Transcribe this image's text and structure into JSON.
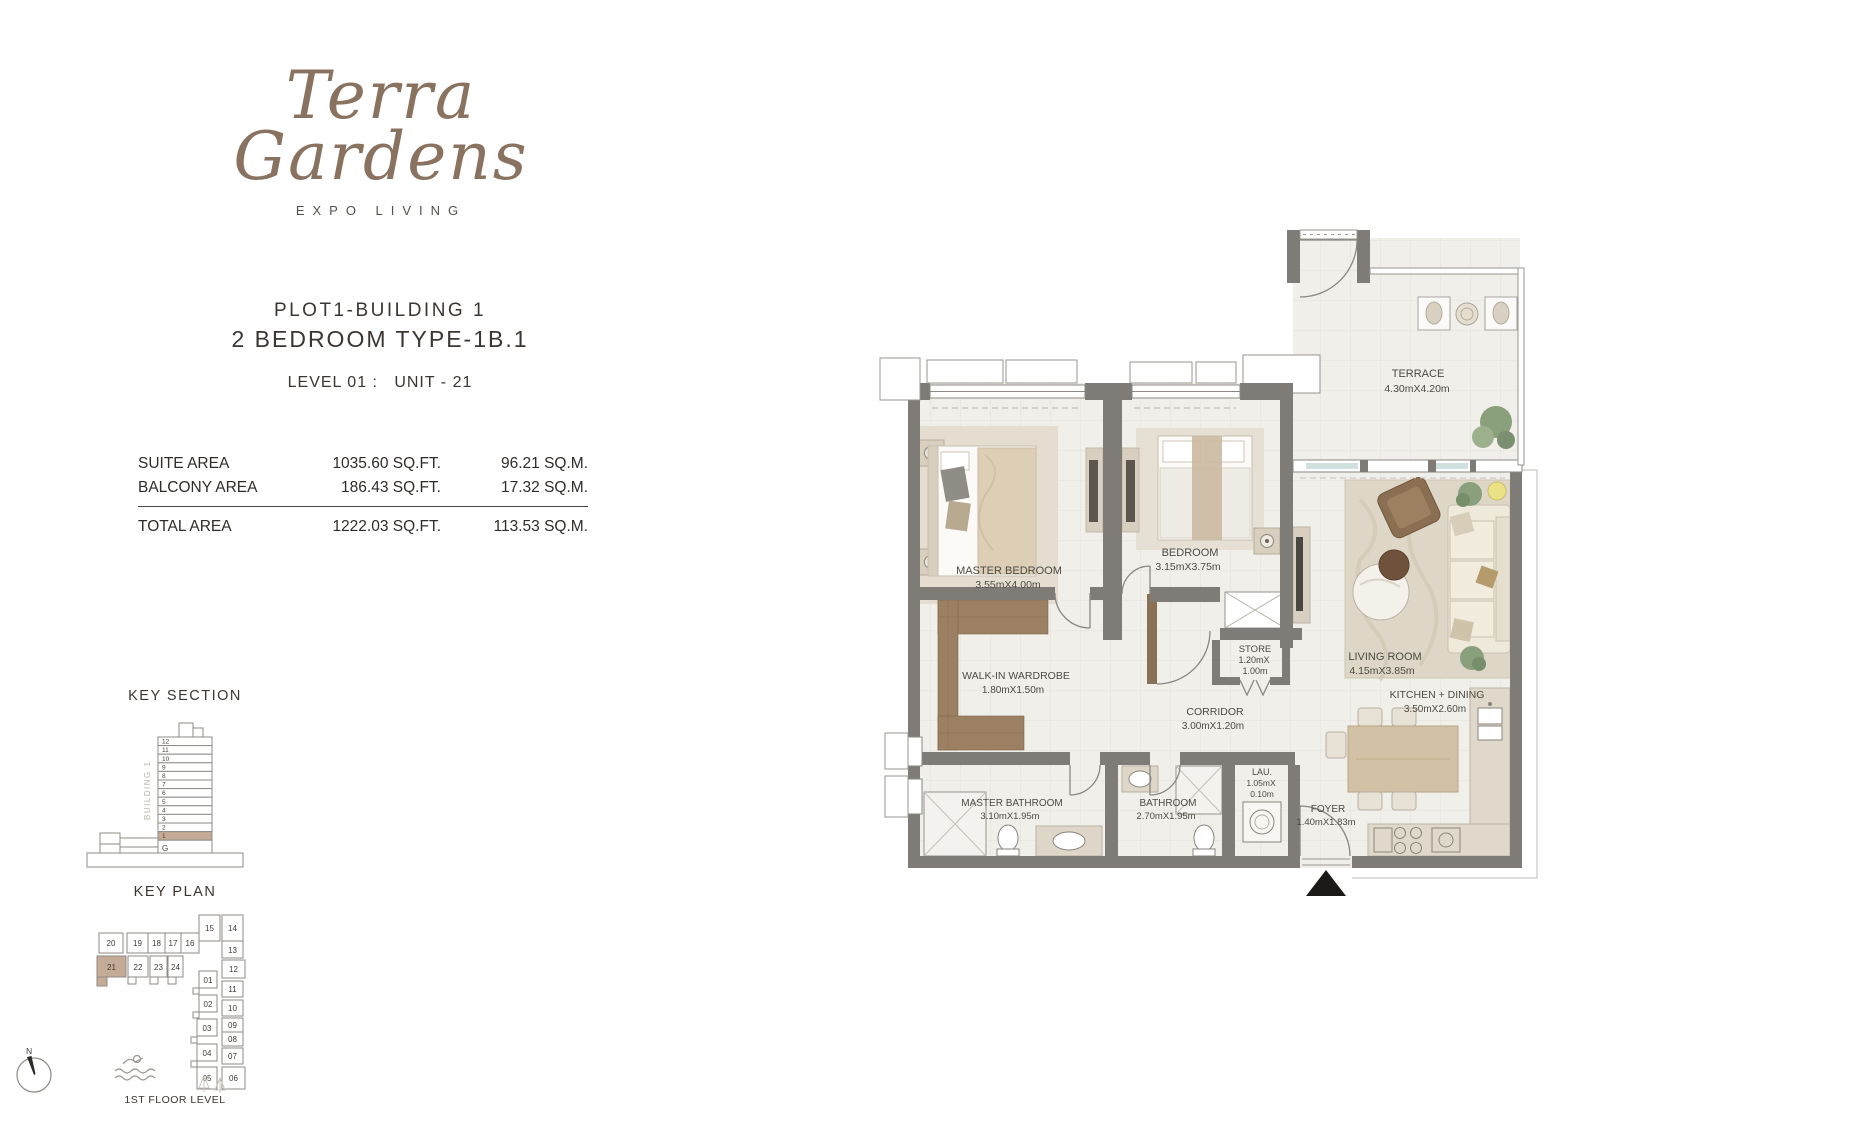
{
  "brand": {
    "name_line1": "Terra",
    "name_line2": "Gardens",
    "tagline": "EXPO LIVING"
  },
  "header": {
    "plot": "PLOT1-BUILDING 1",
    "unit_type": "2 BEDROOM TYPE-1B.1",
    "level_unit": "LEVEL 01 :   UNIT - 21"
  },
  "areas": {
    "rows": [
      {
        "label": "SUITE AREA",
        "sqft": "1035.60 SQ.FT.",
        "sqm": "96.21 SQ.M."
      },
      {
        "label": "BALCONY AREA",
        "sqft": "186.43 SQ.FT.",
        "sqm": "17.32 SQ.M."
      }
    ],
    "total": {
      "label": "TOTAL AREA",
      "sqft": "1222.03 SQ.FT.",
      "sqm": "113.53 SQ.M."
    }
  },
  "key_section": {
    "title": "KEY SECTION",
    "building_label": "BUILDING 1",
    "floors": [
      "12",
      "11",
      "10",
      "9",
      "8",
      "7",
      "6",
      "5",
      "4",
      "3",
      "2",
      "1",
      "G"
    ],
    "highlighted_floor": "1"
  },
  "key_plan": {
    "title": "KEY PLAN",
    "caption": "1ST FLOOR LEVEL",
    "highlighted_unit": "21",
    "row1": [
      "20",
      "19",
      "18",
      "17",
      "16"
    ],
    "top_units": [
      "15",
      "14"
    ],
    "row2": [
      "21",
      "22",
      "23",
      "24"
    ],
    "left_column": [
      "01",
      "02",
      "03",
      "04",
      "05"
    ],
    "right_column": [
      "13",
      "12",
      "11",
      "10",
      "09",
      "08",
      "07",
      "06"
    ]
  },
  "compass": {
    "label": "N"
  },
  "floor_plan": {
    "rooms": [
      {
        "name": "MASTER BEDROOM",
        "dims": "3.55mX4.00m"
      },
      {
        "name": "BEDROOM",
        "dims": "3.15mX3.75m"
      },
      {
        "name": "TERRACE",
        "dims": "4.30mX4.20m"
      },
      {
        "name": "LIVING ROOM",
        "dims": "4.15mX3.85m"
      },
      {
        "name": "WALK-IN WARDROBE",
        "dims": "1.80mX1.50m"
      },
      {
        "name": "STORE",
        "dims": "1.20mX",
        "dims2": "1.00m"
      },
      {
        "name": "CORRIDOR",
        "dims": "3.00mX1.20m"
      },
      {
        "name": "MASTER BATHROOM",
        "dims": "3.10mX1.95m"
      },
      {
        "name": "BATHROOM",
        "dims": "2.70mX1.95m"
      },
      {
        "name": "LAU.",
        "dims": "1.05mX",
        "dims2": "0.10m"
      },
      {
        "name": "KITCHEN + DINING",
        "dims": "3.50mX2.60m"
      },
      {
        "name": "FOYER",
        "dims": "1.40mX1.83m"
      }
    ]
  },
  "colors": {
    "brand_brown": "#8a7260",
    "text_dark": "#3b3631",
    "wall_gray": "#7f7c78",
    "floor_light": "#f1efea",
    "highlight_tan": "#c4ab96",
    "wood": "#9b8063",
    "rug": "#e2dbce",
    "plant_green": "#87a078"
  }
}
